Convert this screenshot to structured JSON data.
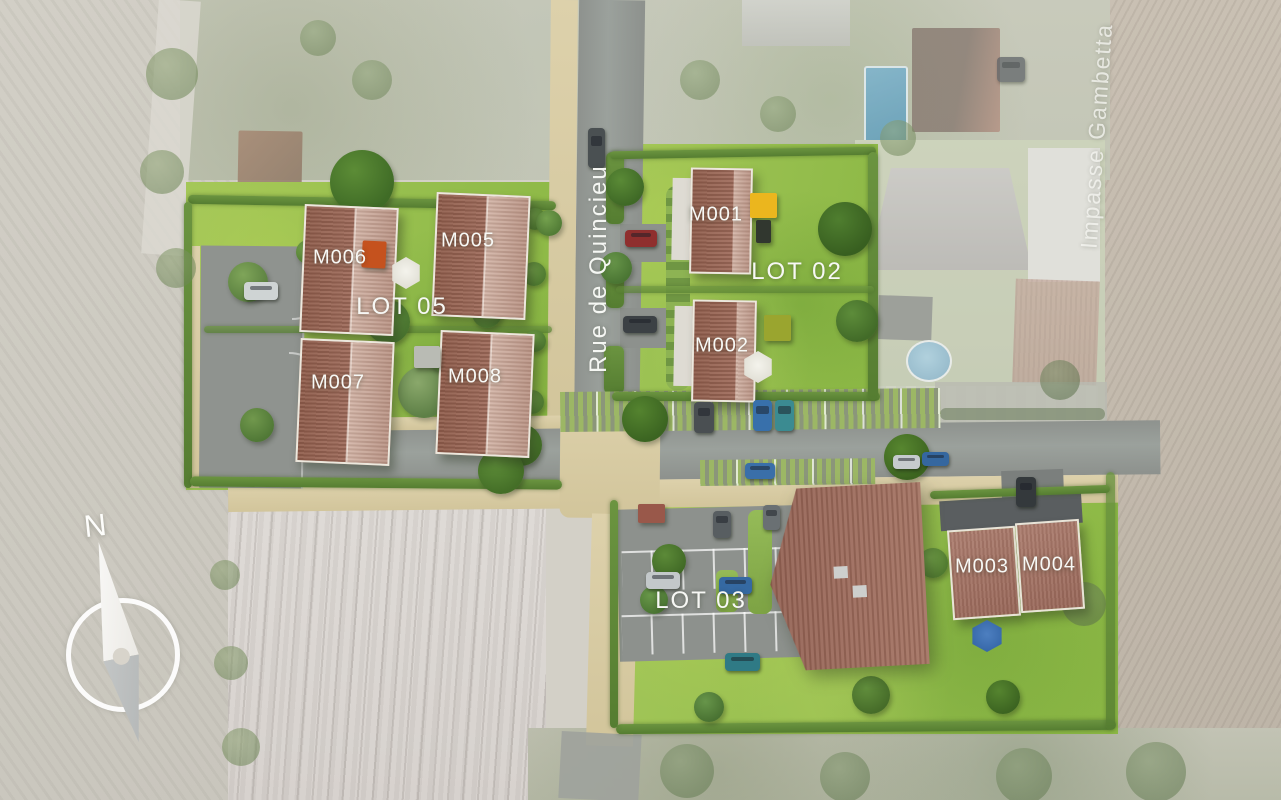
{
  "plan": {
    "compass_north": "N",
    "streets": [
      {
        "id": "rue-de-quincieu",
        "name": "Rue de Quincieu"
      },
      {
        "id": "impasse-gambetta",
        "name": "Impasse Gambetta"
      }
    ],
    "lots": [
      {
        "id": "lot-02",
        "label": "LOT 02",
        "units": [
          "M001",
          "M002"
        ]
      },
      {
        "id": "lot-05",
        "label": "LOT 05",
        "units": [
          "M005",
          "M006",
          "M007",
          "M008"
        ]
      },
      {
        "id": "lot-03",
        "label": "LOT 03",
        "units": [
          "M003",
          "M004"
        ]
      }
    ],
    "units": [
      {
        "id": "M001",
        "label": "M001"
      },
      {
        "id": "M002",
        "label": "M002"
      },
      {
        "id": "M003",
        "label": "M003"
      },
      {
        "id": "M004",
        "label": "M004"
      },
      {
        "id": "M005",
        "label": "M005"
      },
      {
        "id": "M006",
        "label": "M006"
      },
      {
        "id": "M007",
        "label": "M007"
      },
      {
        "id": "M008",
        "label": "M008"
      }
    ],
    "colors": {
      "lawn": "#9cc253",
      "hedge": "#5f8a38",
      "roof_dark": "#9b675a",
      "roof_light": "#cbab9e",
      "road": "#939792",
      "path": "#d9cda6",
      "field": "#d6d2c9",
      "label_text": "#f7f8f5"
    }
  }
}
